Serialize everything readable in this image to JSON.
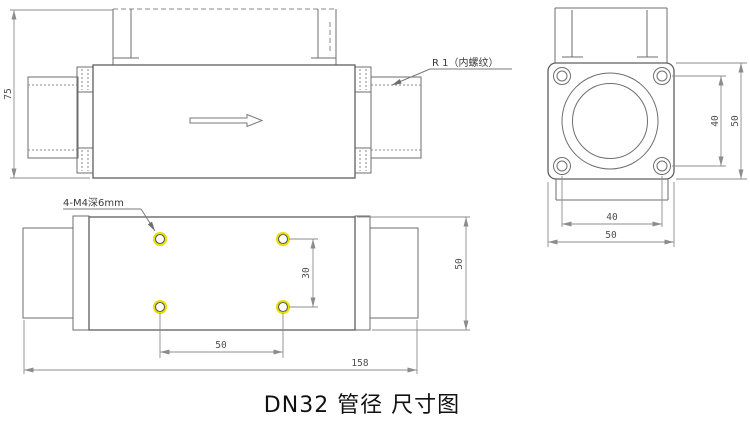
{
  "caption": "DN32 管径 尺寸图",
  "colors": {
    "outline": "#5f5f5f",
    "dim_line": "#8c8c8c",
    "dim_text": "#4f4f4f",
    "hole_highlight": "#e8de00",
    "caption_text": "#111111"
  },
  "side_view": {
    "height": "75",
    "thread_label": "R 1（内螺纹）"
  },
  "plan_view": {
    "holes_label": "4-M4深6mm",
    "hole_row_spacing": "30",
    "hole_col_spacing": "50",
    "overall_length": "158",
    "body_width": "50"
  },
  "end_view": {
    "bolt_spacing_vertical": "40",
    "flange_height": "50",
    "bolt_spacing_horizontal": "40",
    "flange_width": "50"
  }
}
